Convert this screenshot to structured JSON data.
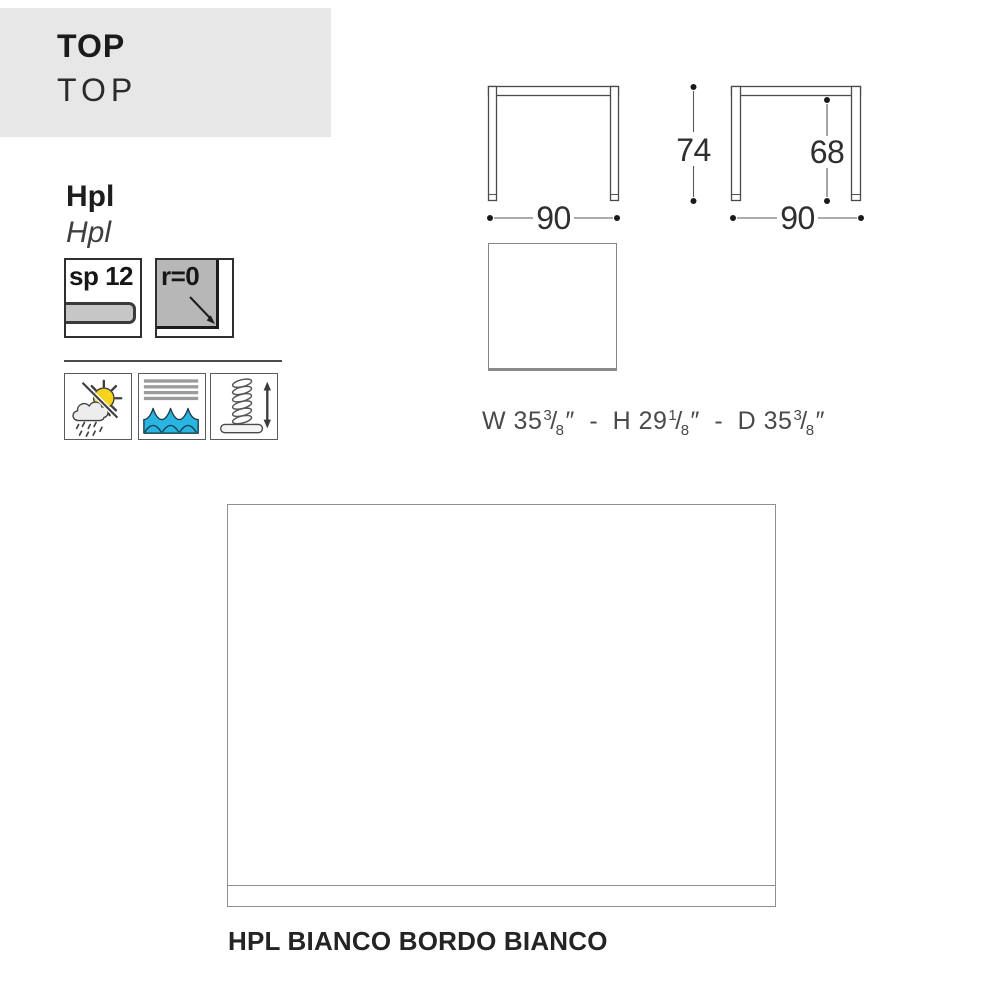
{
  "header": {
    "title": "TOP",
    "subtitle": "TOP"
  },
  "material": {
    "name": "Hpl",
    "name_alt": "Hpl"
  },
  "specs": {
    "thickness_label": "sp 12",
    "radius_label": "r=0"
  },
  "features": {
    "outdoor_icon": "sun-cloud-rain-weatherproof",
    "water_icon": "water-waves",
    "adjustable_icon": "adjustable-screw-foot"
  },
  "drawings": {
    "front_width": "90",
    "front_height": "74",
    "side_clearance": "68",
    "side_width": "90"
  },
  "imperial": {
    "w_pre": "W 35",
    "w_num": "3",
    "w_den": "8",
    "h_pre": "H 29",
    "h_num": "1",
    "h_den": "8",
    "d_pre": "D 35",
    "d_num": "3",
    "d_den": "8",
    "slash": "/",
    "unit": "″",
    "sep": "-"
  },
  "finish": {
    "caption": "HPL BIANCO BORDO BIANCO"
  },
  "colors": {
    "header_bg": "#e7e7e7",
    "sun_yellow": "#f6d41e",
    "wave_blue": "#2ab4e2",
    "bars_gray": "#9b9b9b",
    "corner_gray": "#b7b7b7",
    "bar_gray": "#c6c6c6",
    "line_dark": "#1c1c1c",
    "swatch_fill": "#ffffff"
  }
}
